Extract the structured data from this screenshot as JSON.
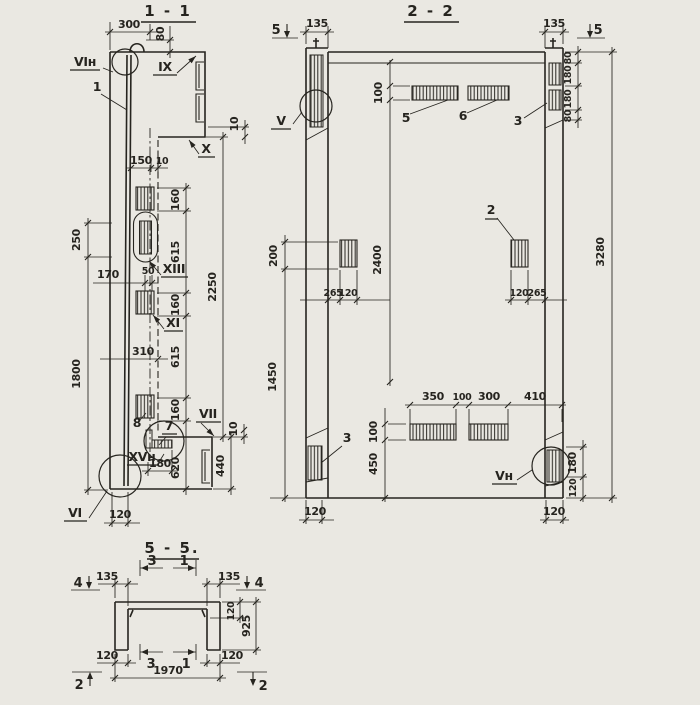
{
  "colors": {
    "paper": "#eae8e2",
    "ink": "#26241f"
  },
  "s11": {
    "title": "1 - 1",
    "node_labels": {
      "vi_n": "VIн",
      "ix": "IX",
      "x": "X",
      "xiii": "XIII",
      "xi": "XI",
      "vii": "VII",
      "xv_n": "XVн",
      "vi": "VI"
    },
    "item_labels": {
      "one": "1",
      "eight": "8",
      "seven": "7"
    },
    "dims": {
      "w300": "300",
      "h80": "80",
      "w150": "150",
      "w10_top": "10",
      "h250": "250",
      "h1800": "1800",
      "w170": "170",
      "w50": "50",
      "h160_1": "160",
      "h615_1": "615",
      "h160_2": "160",
      "h615_2": "615",
      "h160_3": "160",
      "h2250": "2250",
      "w310": "310",
      "h10_step": "10",
      "h10_bot": "10",
      "w180": "180",
      "h620": "620",
      "h440": "440",
      "w120": "120"
    }
  },
  "s22": {
    "title": "2 - 2",
    "node_labels": {
      "v": "V",
      "v_n": "Vн"
    },
    "item_labels": {
      "five": "5",
      "six": "6",
      "three_top": "3",
      "two": "2",
      "three_bot": "3"
    },
    "cut_markers": {
      "left": "5",
      "right": "5"
    },
    "dims": {
      "w135_l": "135",
      "w135_r": "135",
      "h80_1": "80",
      "h180_1": "180",
      "h180_2": "180",
      "h80_2": "80",
      "h100_top": "100",
      "h200": "200",
      "h2400": "2400",
      "w265_l": "265",
      "w120_l": "120",
      "w120_r": "120",
      "w265_r": "265",
      "h3280": "3280",
      "h1450": "1450",
      "w350": "350",
      "w100": "100",
      "w300": "300",
      "w410": "410",
      "h100_bot": "100",
      "h450": "450",
      "h180_r": "180",
      "h120_r": "120",
      "w120_bl": "120",
      "w120_br": "120"
    }
  },
  "s55": {
    "title": "5 - 5.",
    "cut_markers": {
      "four_l": "4",
      "four_r": "4",
      "three_t": "3",
      "one_t": "1",
      "three_b": "3",
      "one_b": "1",
      "two_l": "2",
      "two_r": "2"
    },
    "dims": {
      "w135_l": "135",
      "w135_r": "135",
      "h120": "120",
      "h925": "925",
      "w120_l": "120",
      "w1970": "1970",
      "w120_r": "120"
    }
  }
}
